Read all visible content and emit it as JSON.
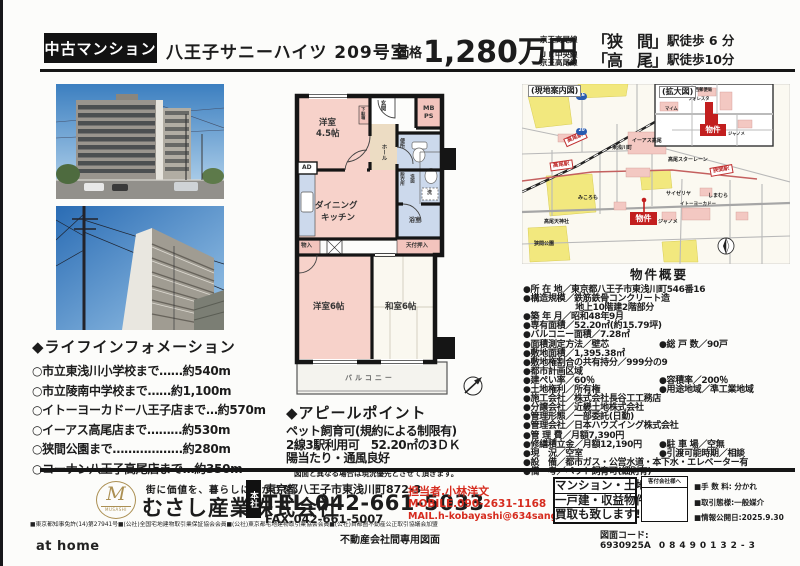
{
  "header": {
    "category": "中古マンション",
    "title": "八王子サニーハイツ 209号室",
    "price_label": "価格",
    "price": "1,280万円",
    "stations": [
      {
        "lines": [
          "京王高尾線"
        ],
        "name": "「狭　間」",
        "walk": "駅徒歩 6 分"
      },
      {
        "lines": [
          "ＪＲ中央線",
          "京王高尾線"
        ],
        "name": "「高　尾」",
        "walk": "駅徒歩10分"
      }
    ]
  },
  "life_info": {
    "title": "◆ライフインフォメーション",
    "items": [
      "○市立東浅川小学校まで……約540m",
      "○市立陵南中学校まで……約1,100m",
      "○イトーヨーカドー八王子店まで…約570m",
      "○イーアス高尾店まで………約530m",
      "○狭間公園まで………………約280m",
      "○コーナン八王子高尾店まで…約350m"
    ]
  },
  "floorplan": {
    "labels": {
      "western45_1": "洋室",
      "western45_2": "4.5帖",
      "shoebox": "下駄箱",
      "entrance": "玄関",
      "mb": "MB",
      "ps": "PS",
      "hall": "ホール",
      "toilet": "便所",
      "dressing": "脱衣所",
      "washstand": "洗面",
      "laundry": "洗",
      "ad": "AD",
      "dk1": "ダイニング",
      "dk2": "キッチン",
      "storage": "物入",
      "closet": "天付押入",
      "bath": "浴室",
      "western6": "洋室6帖",
      "japanese6": "和室6帖",
      "balcony": "バルコニー"
    }
  },
  "appeal": {
    "title": "◆アピールポイント",
    "lines": [
      "ペット飼育可(規約による制限有)",
      "2線3駅利用可　52.20㎡の3ＤＫ",
      "陽当たり・通風良好"
    ],
    "note": "図面と異なる場合は現況優先とさせて頂きます。"
  },
  "map": {
    "caption": "(現地案内図)",
    "inset_caption": "(拡大図)",
    "property_label": "物件",
    "stations": {
      "takao_jr": "高尾駅",
      "takao_keio": "高尾駅",
      "hazama": "狭間駅"
    },
    "routes": {
      "r46": "46",
      "r20": "20"
    },
    "places": {
      "ieas": "イーアス高尾",
      "starlane": "高尾スターレーン",
      "itoyokado": "イトーヨーカドー",
      "shimamura": "しまむら",
      "janome": "ジャノメ",
      "saizeriya": "サイゼリヤ",
      "mikoromo": "みころも",
      "tenjinsha": "高尾天神社",
      "hazamapark": "狭間公園",
      "higashiasakawa": "東浅川町",
      "postoffice": "八王子西郵便局",
      "foresta": "フォレスタ",
      "maimu": "マイム",
      "janome2": "ジャノメ"
    }
  },
  "overview": {
    "title": "物件概要",
    "rows": [
      {
        "l": "●所 在 地／東京都八王子市東浅川町546番16",
        "r": ""
      },
      {
        "l": "●構造規模／鉄筋鉄骨コンクリート造",
        "r": ""
      },
      {
        "l": "　　　　　　地上10階建2階部分",
        "r": ""
      },
      {
        "l": "●築 年 月／昭和48年9月",
        "r": ""
      },
      {
        "l": "●専有面積／52.20㎡(約15.79坪)",
        "r": ""
      },
      {
        "l": "●バルコニー面積／7.28㎡",
        "r": ""
      },
      {
        "l": "●面積測定方法／壁芯",
        "r": "●総 戸 数／90戸"
      },
      {
        "l": "●敷地面積／1,395.38㎡",
        "r": ""
      },
      {
        "l": "●敷地権割合の共有持分／999分の9",
        "r": ""
      },
      {
        "l": "●都市計画区域",
        "r": ""
      },
      {
        "l": "●建ぺい率／60％",
        "r": "●容積率／200％"
      },
      {
        "l": "●土地権利／所有権",
        "r": "●用途地域／準工業地域"
      },
      {
        "l": "●施工会社／株式会社長谷工工務店",
        "r": ""
      },
      {
        "l": "●分譲会社／近畿土地株式会社",
        "r": ""
      },
      {
        "l": "●管理形態／一部委託(日勤)",
        "r": ""
      },
      {
        "l": "●管理会社／日本ハウズイング株式会社",
        "r": ""
      },
      {
        "l": "●管 理 費／月額7,390円",
        "r": ""
      },
      {
        "l": "●修繕積立金／月額12,190円",
        "r": "●駐 車 場／空無"
      },
      {
        "l": "●現　況／空室",
        "r": "●引渡可能時期／相談"
      },
      {
        "l": "●設　備／都市ガス・公営水道・本下水・エレベーター有",
        "r": ""
      },
      {
        "l": "●備　考／ペット飼育可(細則有)",
        "r": ""
      }
    ]
  },
  "footer": {
    "tagline": "街に価値を、暮らしに豊かさを。",
    "company": "むさし産業株式会社",
    "logo_m": "M",
    "logo_sub": "MUSASHI",
    "license": "■東京都知事免許(14)第27941号■(公社)全国宅地建物取引業保証協会会員■(公社)東京都宅地建物取引業協会会員■(公社)首都圏不動産公正取引協議会加盟",
    "head_office_label": "本社",
    "address": "東京都八王子市東浅川町872-3",
    "tel": "TEL.042-661-5033",
    "fax": "FAX.042-661-5007",
    "contact": "担当者.小林洋文",
    "mobile": "MOBILE.090-2631-1168",
    "mail": "MAIL.h-kobayashi@634sangyo.co.jp",
    "purchase_lines": [
      "マンション・土地・",
      "一戸建・収益物件",
      "買取も致します!"
    ],
    "client_box_label": "客付会社様へ",
    "fee": "■手 数 料: 分かれ",
    "transaction": "■取引態様:一般媒介",
    "published": "■情報公開日:2025.9.30",
    "diagram_code_label": "図面コード: 6930925A",
    "diagram_code2": "08490132-3",
    "athome": "at home",
    "doc_type": "不動産会社間専用図面"
  }
}
